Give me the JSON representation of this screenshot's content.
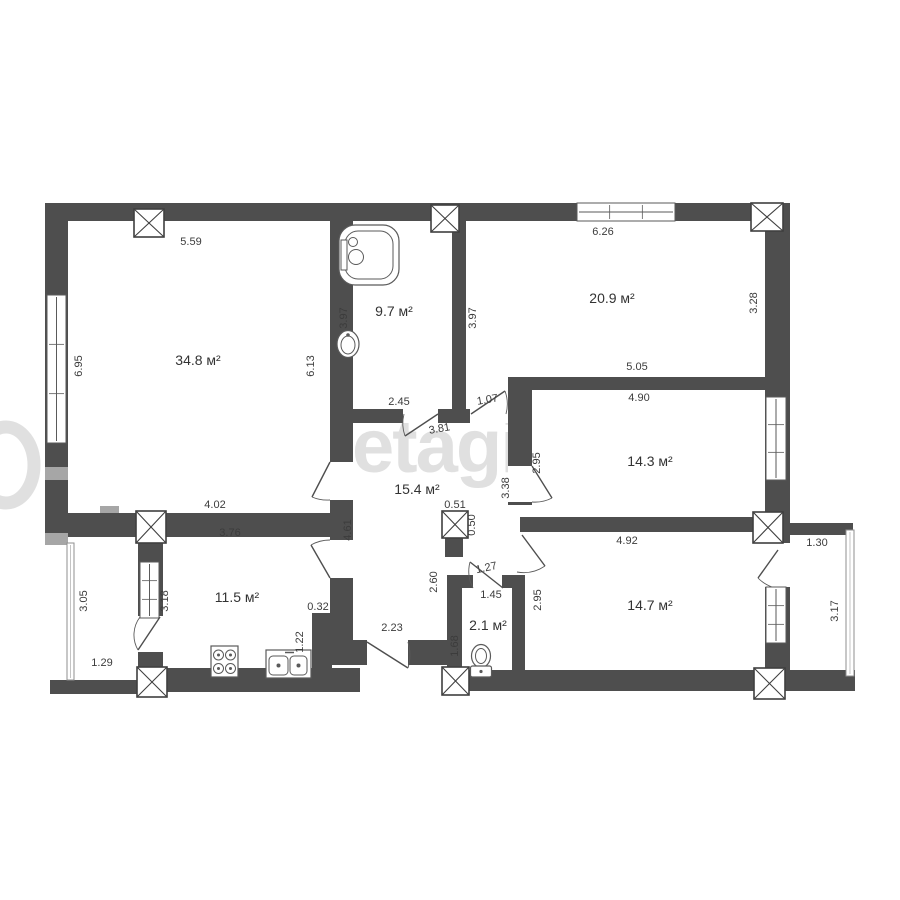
{
  "meta": {
    "background": "#ffffff",
    "wall_color": "#4e4e4e",
    "line_color": "#5a5a5a",
    "column_stroke": "#3f3f3f",
    "text_color": "#3c3c3c",
    "light_patch_color": "#a6a6a6",
    "watermark_color": "#e0e0e0",
    "dimension_font_px": 11,
    "room_font_px": 14
  },
  "watermark": {
    "text": "etagi"
  },
  "rooms": [
    {
      "id": "living-room",
      "area": "34.8 м²",
      "x": 198,
      "y": 365
    },
    {
      "id": "bathroom",
      "area": "9.7 м²",
      "x": 394,
      "y": 316
    },
    {
      "id": "room-20-9",
      "area": "20.9 м²",
      "x": 612,
      "y": 303
    },
    {
      "id": "room-14-3",
      "area": "14.3 м²",
      "x": 650,
      "y": 466
    },
    {
      "id": "hallway",
      "area": "15.4 м²",
      "x": 417,
      "y": 494
    },
    {
      "id": "kitchen",
      "area": "11.5 м²",
      "x": 237,
      "y": 602
    },
    {
      "id": "wc",
      "area": "2.1 м²",
      "x": 488,
      "y": 630
    },
    {
      "id": "room-14-7",
      "area": "14.7 м²",
      "x": 650,
      "y": 610
    }
  ],
  "dimensions": [
    {
      "text": "5.59",
      "x": 191,
      "y": 245,
      "rot": 0
    },
    {
      "text": "6.26",
      "x": 603,
      "y": 235,
      "rot": 0
    },
    {
      "text": "6.95",
      "x": 82,
      "y": 366,
      "rot": -90
    },
    {
      "text": "6.13",
      "x": 314,
      "y": 366,
      "rot": -90
    },
    {
      "text": "3.97",
      "x": 347,
      "y": 318,
      "rot": -90
    },
    {
      "text": "3.97",
      "x": 476,
      "y": 318,
      "rot": -90
    },
    {
      "text": "3.28",
      "x": 757,
      "y": 303,
      "rot": -90
    },
    {
      "text": "2.45",
      "x": 399,
      "y": 405,
      "rot": 0
    },
    {
      "text": "1.07",
      "x": 488,
      "y": 403,
      "rot": -10
    },
    {
      "text": "3.81",
      "x": 440,
      "y": 432,
      "rot": -10
    },
    {
      "text": "5.05",
      "x": 637,
      "y": 370,
      "rot": 0
    },
    {
      "text": "4.90",
      "x": 639,
      "y": 401,
      "rot": 0
    },
    {
      "text": "2.95",
      "x": 540,
      "y": 463,
      "rot": -90
    },
    {
      "text": "3.38",
      "x": 509,
      "y": 488,
      "rot": -90
    },
    {
      "text": "4.02",
      "x": 215,
      "y": 508,
      "rot": 0
    },
    {
      "text": "3.76",
      "x": 230,
      "y": 536,
      "rot": 0
    },
    {
      "text": "4.61",
      "x": 351,
      "y": 530,
      "rot": -90
    },
    {
      "text": "0.51",
      "x": 455,
      "y": 508,
      "rot": 0
    },
    {
      "text": "0.50",
      "x": 475,
      "y": 525,
      "rot": -90
    },
    {
      "text": "4.92",
      "x": 627,
      "y": 544,
      "rot": 0
    },
    {
      "text": "1.30",
      "x": 817,
      "y": 546,
      "rot": 0
    },
    {
      "text": "3.05",
      "x": 87,
      "y": 601,
      "rot": -90
    },
    {
      "text": "3.18",
      "x": 168,
      "y": 601,
      "rot": -90
    },
    {
      "text": "0.32",
      "x": 318,
      "y": 610,
      "rot": 0
    },
    {
      "text": "2.60",
      "x": 437,
      "y": 582,
      "rot": -90
    },
    {
      "text": "1.27",
      "x": 487,
      "y": 571,
      "rot": -12
    },
    {
      "text": "1.45",
      "x": 491,
      "y": 598,
      "rot": 0
    },
    {
      "text": "2.95",
      "x": 541,
      "y": 600,
      "rot": -90
    },
    {
      "text": "3.17",
      "x": 838,
      "y": 611,
      "rot": -90
    },
    {
      "text": "1.22",
      "x": 303,
      "y": 642,
      "rot": -90
    },
    {
      "text": "1.68",
      "x": 458,
      "y": 646,
      "rot": -90
    },
    {
      "text": "2.23",
      "x": 392,
      "y": 631,
      "rot": 0
    },
    {
      "text": "1.29",
      "x": 102,
      "y": 666,
      "rot": 0
    }
  ],
  "plan": {
    "walls": [
      {
        "x": 45,
        "y": 203,
        "w": 745,
        "h": 18
      },
      {
        "x": 45,
        "y": 203,
        "w": 23,
        "h": 342
      },
      {
        "x": 45,
        "y": 513,
        "w": 290,
        "h": 24
      },
      {
        "x": 138,
        "y": 537,
        "w": 25,
        "h": 131
      },
      {
        "x": 50,
        "y": 680,
        "w": 113,
        "h": 14
      },
      {
        "x": 160,
        "y": 668,
        "w": 200,
        "h": 24
      },
      {
        "x": 444,
        "y": 670,
        "w": 411,
        "h": 21
      },
      {
        "x": 332,
        "y": 640,
        "w": 115,
        "h": 25
      },
      {
        "x": 330,
        "y": 221,
        "w": 23,
        "h": 419
      },
      {
        "x": 452,
        "y": 221,
        "w": 14,
        "h": 188
      },
      {
        "x": 352,
        "y": 409,
        "w": 180,
        "h": 14
      },
      {
        "x": 508,
        "y": 377,
        "w": 257,
        "h": 13
      },
      {
        "x": 508,
        "y": 390,
        "w": 24,
        "h": 115
      },
      {
        "x": 520,
        "y": 517,
        "w": 235,
        "h": 15
      },
      {
        "x": 782,
        "y": 523,
        "w": 71,
        "h": 12
      },
      {
        "x": 447,
        "y": 575,
        "w": 15,
        "h": 95
      },
      {
        "x": 445,
        "y": 537,
        "w": 18,
        "h": 20
      },
      {
        "x": 512,
        "y": 587,
        "w": 13,
        "h": 84
      },
      {
        "x": 765,
        "y": 203,
        "w": 25,
        "h": 487
      },
      {
        "x": 447,
        "y": 575,
        "w": 26,
        "h": 13
      },
      {
        "x": 502,
        "y": 575,
        "w": 23,
        "h": 13
      },
      {
        "x": 312,
        "y": 613,
        "w": 20,
        "h": 55
      }
    ],
    "light_patches": [
      {
        "x": 45,
        "y": 467,
        "w": 23,
        "h": 13
      },
      {
        "x": 100,
        "y": 506,
        "w": 19,
        "h": 7
      },
      {
        "x": 45,
        "y": 533,
        "w": 23,
        "h": 12
      }
    ],
    "door_openings": [
      {
        "x": 330,
        "y": 462,
        "w": 23,
        "h": 38
      },
      {
        "x": 330,
        "y": 540,
        "w": 23,
        "h": 38
      },
      {
        "x": 403,
        "y": 409,
        "w": 35,
        "h": 14
      },
      {
        "x": 470,
        "y": 409,
        "w": 38,
        "h": 14
      },
      {
        "x": 508,
        "y": 466,
        "w": 24,
        "h": 36
      },
      {
        "x": 367,
        "y": 640,
        "w": 41,
        "h": 25
      },
      {
        "x": 138,
        "y": 616,
        "w": 25,
        "h": 36
      },
      {
        "x": 765,
        "y": 543,
        "w": 25,
        "h": 44
      }
    ],
    "windows": [
      {
        "x": 47,
        "y": 295,
        "w": 19,
        "h": 148,
        "o": "v"
      },
      {
        "x": 577,
        "y": 203,
        "w": 98,
        "h": 18,
        "o": "h"
      },
      {
        "x": 766,
        "y": 397,
        "w": 20,
        "h": 83,
        "o": "v"
      },
      {
        "x": 766,
        "y": 587,
        "w": 20,
        "h": 56,
        "o": "v"
      },
      {
        "x": 140,
        "y": 562,
        "w": 19,
        "h": 56,
        "o": "v"
      }
    ],
    "railings": [
      {
        "x": 67,
        "y": 543,
        "w": 7,
        "h": 137
      },
      {
        "x": 846,
        "y": 530,
        "w": 8,
        "h": 146
      }
    ],
    "columns": [
      {
        "x": 134,
        "y": 209,
        "w": 30,
        "h": 28
      },
      {
        "x": 431,
        "y": 205,
        "w": 28,
        "h": 27
      },
      {
        "x": 751,
        "y": 203,
        "w": 32,
        "h": 28
      },
      {
        "x": 136,
        "y": 511,
        "w": 30,
        "h": 32
      },
      {
        "x": 442,
        "y": 511,
        "w": 26,
        "h": 27
      },
      {
        "x": 753,
        "y": 512,
        "w": 30,
        "h": 31
      },
      {
        "x": 137,
        "y": 667,
        "w": 30,
        "h": 30
      },
      {
        "x": 442,
        "y": 667,
        "w": 27,
        "h": 28
      },
      {
        "x": 754,
        "y": 668,
        "w": 31,
        "h": 31
      }
    ],
    "doors": [
      {
        "id": "bathroom-door",
        "h": [
          438,
          414
        ],
        "f": [
          405,
          436
        ],
        "j": [
          404,
          414
        ]
      },
      {
        "id": "door-to-room-20-9",
        "h": [
          471,
          414
        ],
        "f": [
          505,
          391
        ],
        "j": [
          506,
          414
        ]
      },
      {
        "id": "living-room-door",
        "h": [
          330,
          462
        ],
        "f": [
          312,
          497
        ],
        "j": [
          330,
          500
        ]
      },
      {
        "id": "kitchen-door",
        "h": [
          330,
          578
        ],
        "f": [
          311,
          545
        ],
        "j": [
          330,
          540
        ]
      },
      {
        "id": "room-14-3-door",
        "h": [
          532,
          466
        ],
        "f": [
          552,
          498
        ],
        "j": [
          532,
          502
        ]
      },
      {
        "id": "room-14-7-door",
        "h": [
          522,
          535
        ],
        "f": [
          545,
          566
        ],
        "j": [
          517,
          572
        ]
      },
      {
        "id": "wc-door",
        "h": [
          503,
          588
        ],
        "f": [
          470,
          562
        ],
        "j": [
          473,
          588
        ]
      },
      {
        "id": "entrance-door",
        "h": [
          367,
          642
        ],
        "f": [
          408,
          668
        ],
        "j": [
          408,
          642
        ]
      },
      {
        "id": "kitchen-balcony-door",
        "h": [
          160,
          617
        ],
        "f": [
          138,
          650
        ],
        "j": [
          140,
          617
        ]
      },
      {
        "id": "balcony-door-14-7",
        "h": [
          778,
          550
        ],
        "f": [
          758,
          578
        ],
        "j": [
          772,
          587
        ]
      }
    ],
    "fixtures": {
      "bathtub": {
        "x": 339,
        "y": 225,
        "size": 60
      },
      "bath_sink": {
        "cx": 348,
        "cy": 344
      },
      "toilet": {
        "cx": 481,
        "cy": 656
      },
      "stove": {
        "x": 211,
        "y": 646,
        "w": 27,
        "h": 31
      },
      "kitchen_sink": {
        "x": 266,
        "y": 650,
        "w": 45,
        "h": 28
      }
    }
  }
}
